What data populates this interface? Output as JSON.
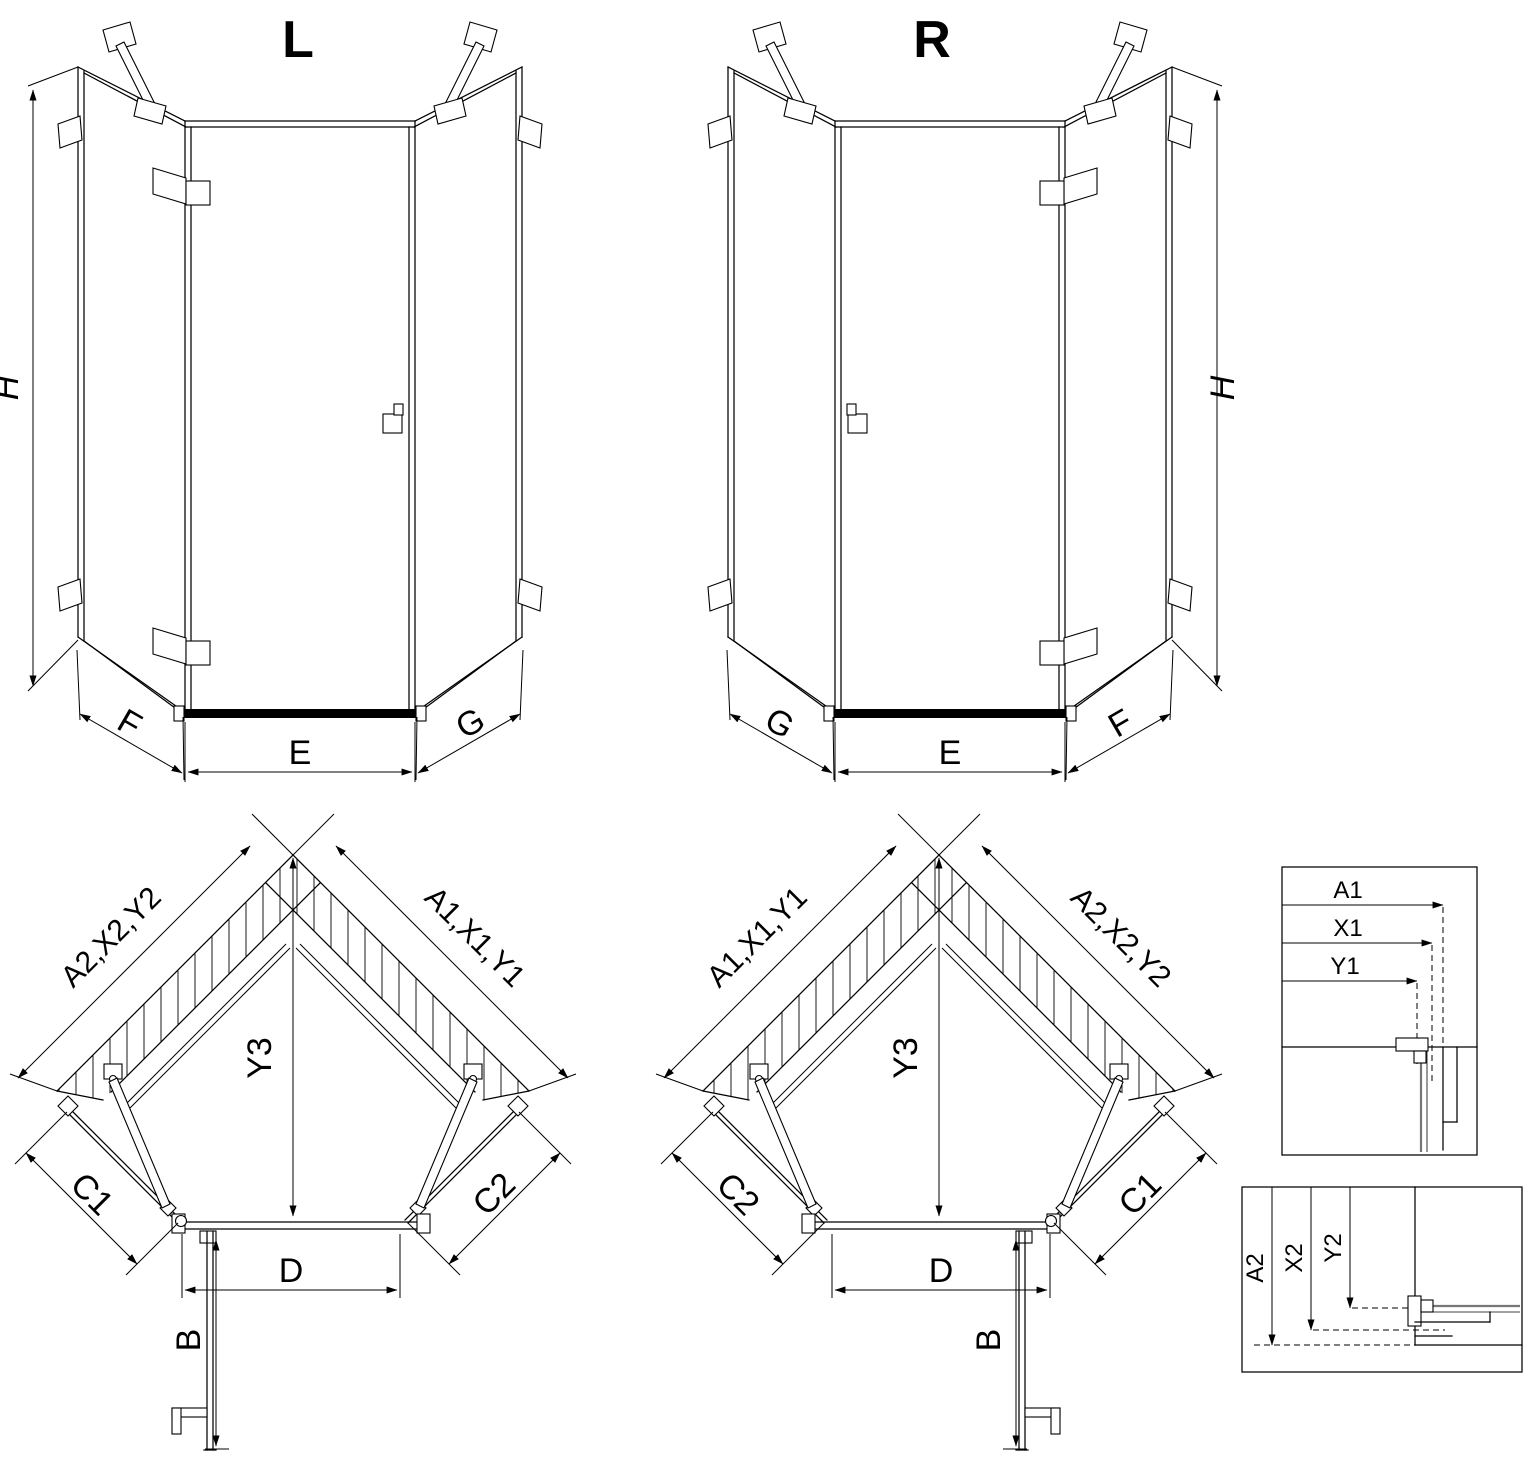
{
  "views": {
    "iso_left": {
      "title": "L",
      "dim_height": "H",
      "dim_left": "F",
      "dim_center": "E",
      "dim_right": "G"
    },
    "iso_right": {
      "title": "R",
      "dim_height": "H",
      "dim_left": "G",
      "dim_center": "E",
      "dim_right": "F"
    },
    "plan_left": {
      "wall_left": "A2,X2,Y2",
      "wall_right": "A1,X1,Y1",
      "depth": "Y3",
      "side_left": "C1",
      "side_right": "C2",
      "door_width": "D",
      "door_swing": "B"
    },
    "plan_right": {
      "wall_left": "A1,X1,Y1",
      "wall_right": "A2,X2,Y2",
      "depth": "Y3",
      "side_left": "C2",
      "side_right": "C1",
      "door_width": "D",
      "door_swing": "B"
    },
    "detail_top": {
      "dim_1": "A1",
      "dim_2": "X1",
      "dim_3": "Y1"
    },
    "detail_bottom": {
      "dim_1": "A2",
      "dim_2": "X2",
      "dim_3": "Y2"
    }
  },
  "colors": {
    "line": "#000000",
    "background": "#ffffff",
    "profile_gray": "#777777"
  }
}
